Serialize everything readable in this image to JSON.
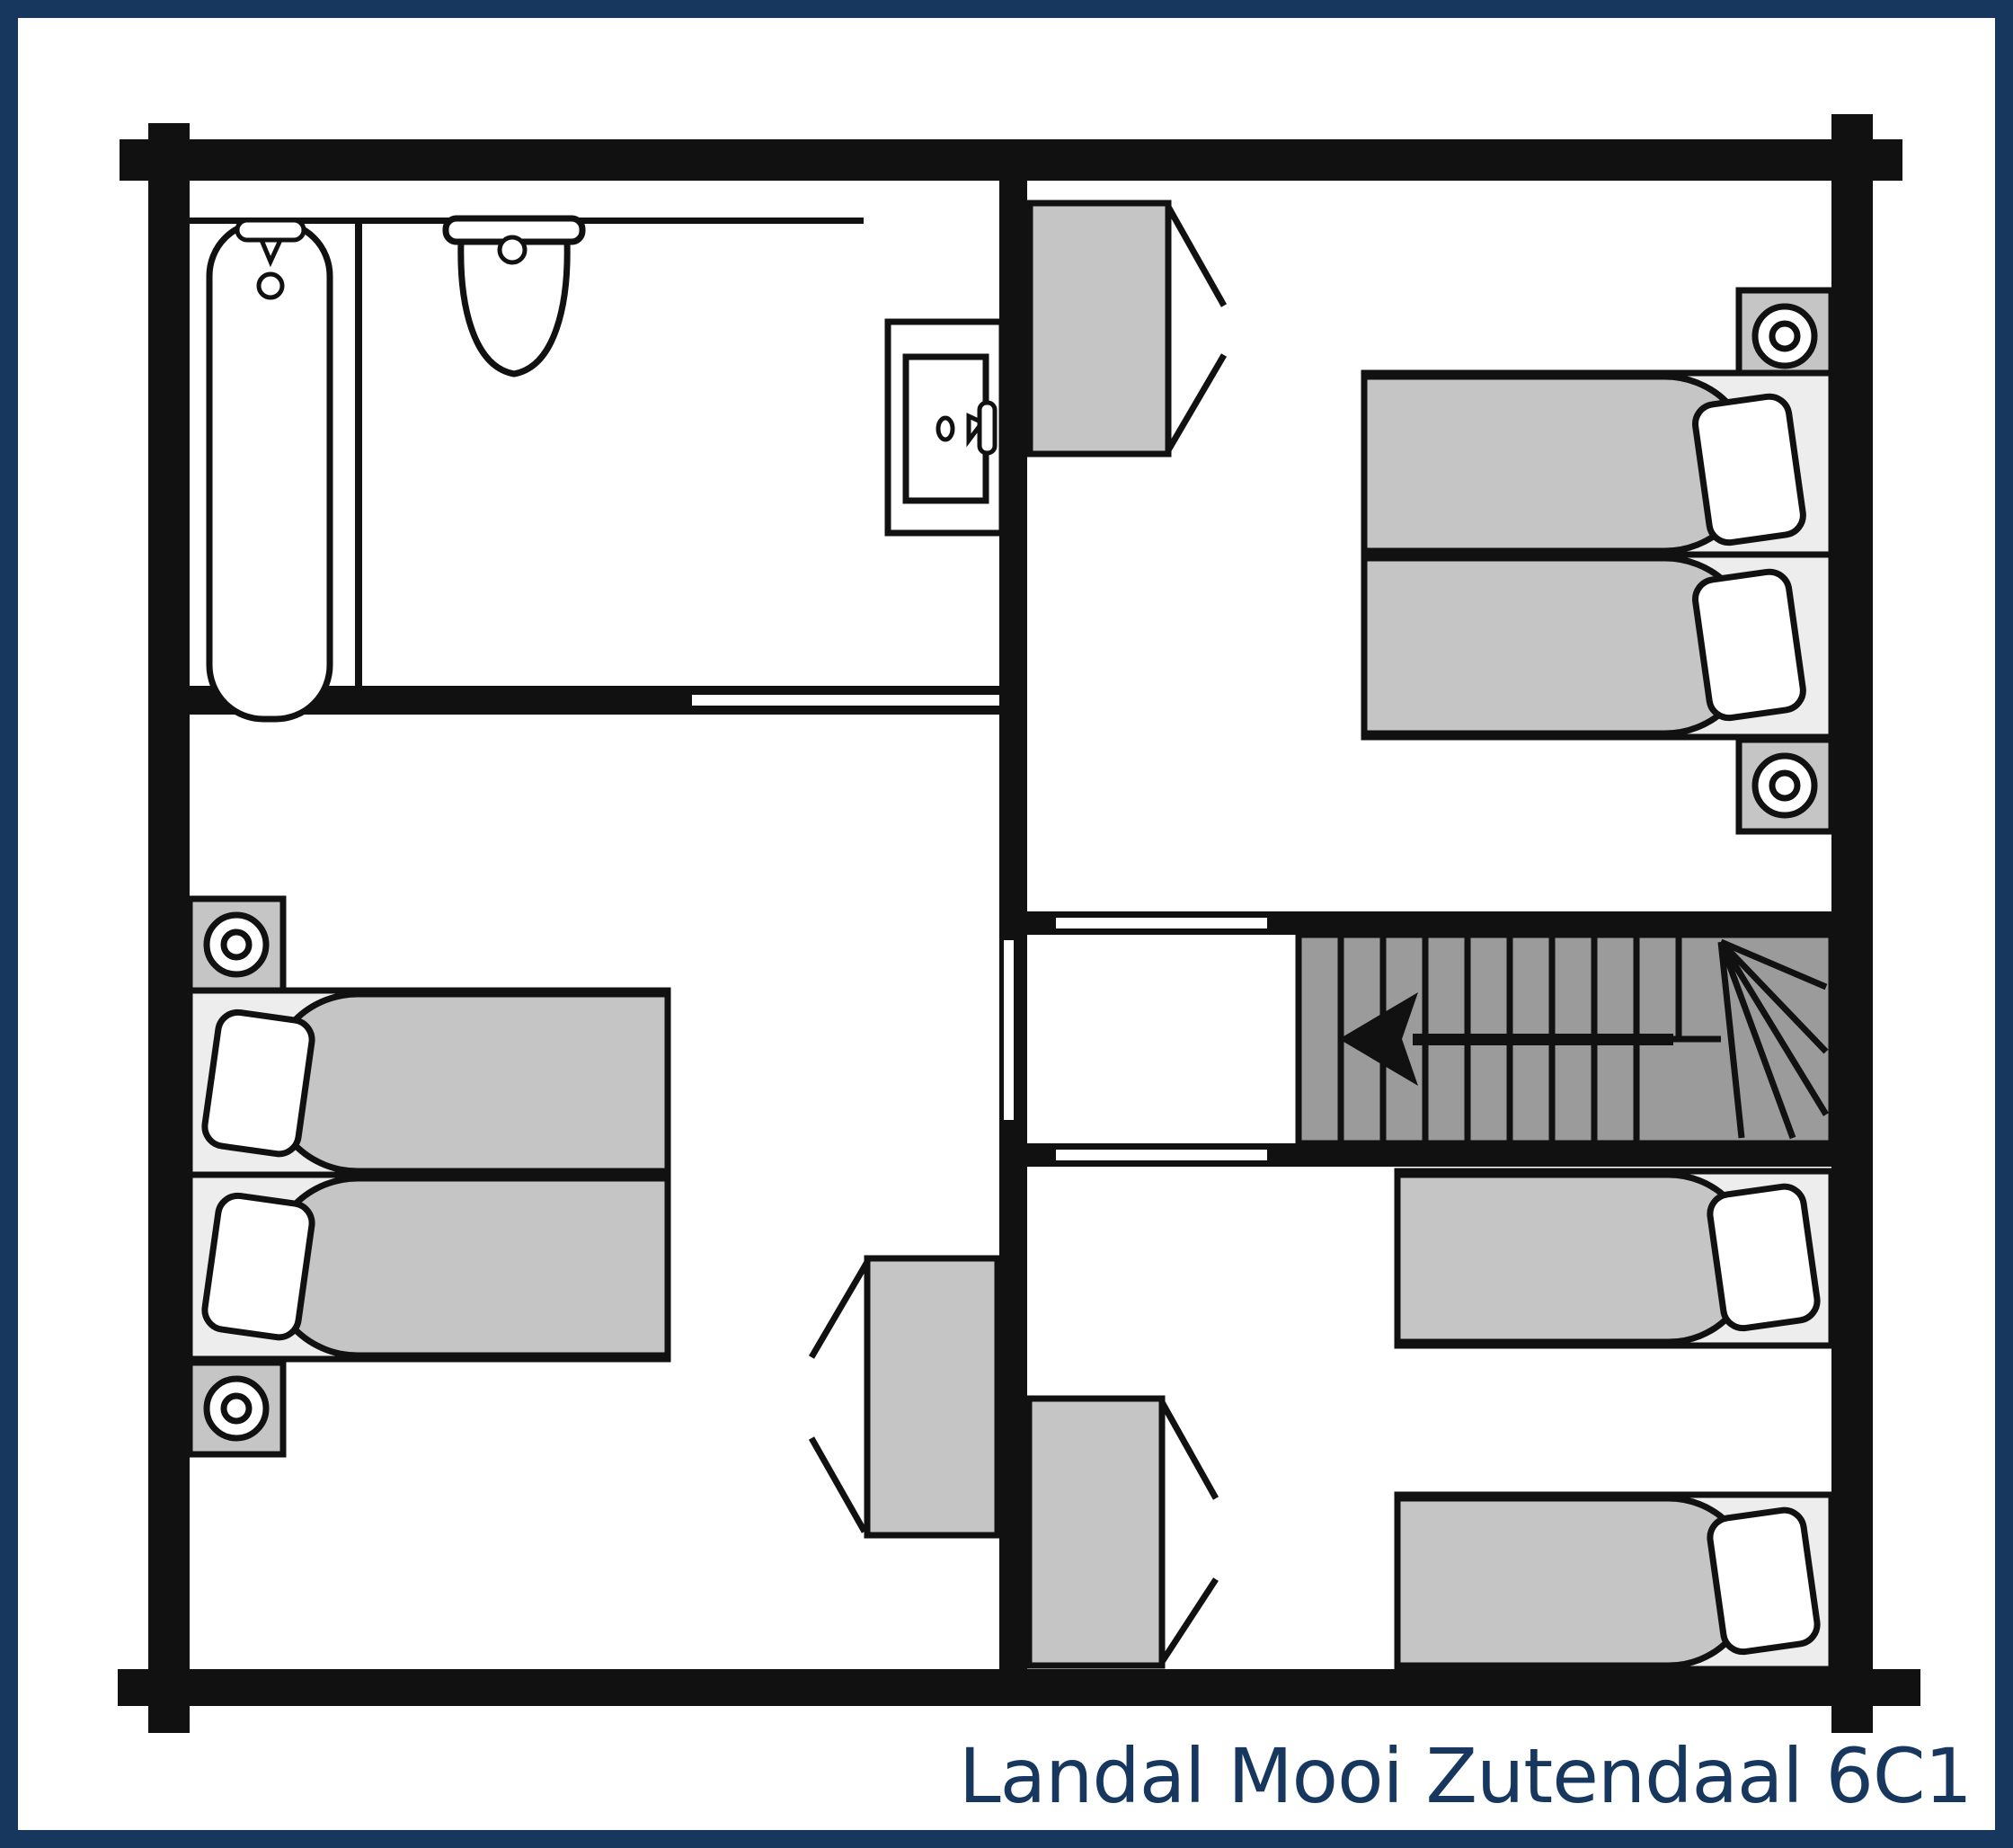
{
  "title": {
    "text": "Landal Mooi Zutendaal 6C1"
  },
  "colors": {
    "frame": "#17375e",
    "title": "#17375e",
    "wall": "#111111",
    "stairs_fill": "#9b9b9b",
    "furniture_fill": "#c5c5c5",
    "bed_base_fill": "#ededed",
    "background": "#ffffff",
    "fixture_fill": "#ffffff"
  },
  "floorplan": {
    "type": "cottage-upper-floor",
    "rooms": [
      {
        "name": "bathroom",
        "position": "top-left",
        "fixtures": [
          "bathtub",
          "bathtub-taps",
          "toilet",
          "door-panel",
          "shower-partition"
        ]
      },
      {
        "name": "bedroom-top-right",
        "position": "top-right",
        "furniture": [
          "wardrobe-open-doors",
          "nightstand-with-lamp",
          "double-bed-two-duvets",
          "nightstand-with-lamp"
        ]
      },
      {
        "name": "bedroom-left",
        "position": "bottom-left",
        "furniture": [
          "nightstand-with-lamp",
          "double-bed-two-duvets",
          "nightstand-with-lamp",
          "wardrobe-open-doors"
        ]
      },
      {
        "name": "landing",
        "position": "center-right",
        "features": [
          "staircase-straight-treads",
          "staircase-winder-fan",
          "direction-arrow-left",
          "door-opening-top",
          "door-opening-bottom",
          "sliding-door-left"
        ]
      },
      {
        "name": "bedroom-bottom-right",
        "position": "bottom-right",
        "furniture": [
          "wardrobe-open-doors",
          "single-bed",
          "single-bed"
        ]
      }
    ],
    "doors": [
      {
        "name": "bathroom-sliding-door",
        "wall": "bathroom-bottom"
      },
      {
        "name": "bedroom-left-door",
        "wall": "central-vertical"
      },
      {
        "name": "bedroom-top-right-door",
        "wall": "landing-top"
      },
      {
        "name": "bedroom-bottom-right-door",
        "wall": "landing-bottom"
      }
    ],
    "staircase": {
      "arrow_direction": "left",
      "winder_corner": "bottom-right"
    }
  }
}
